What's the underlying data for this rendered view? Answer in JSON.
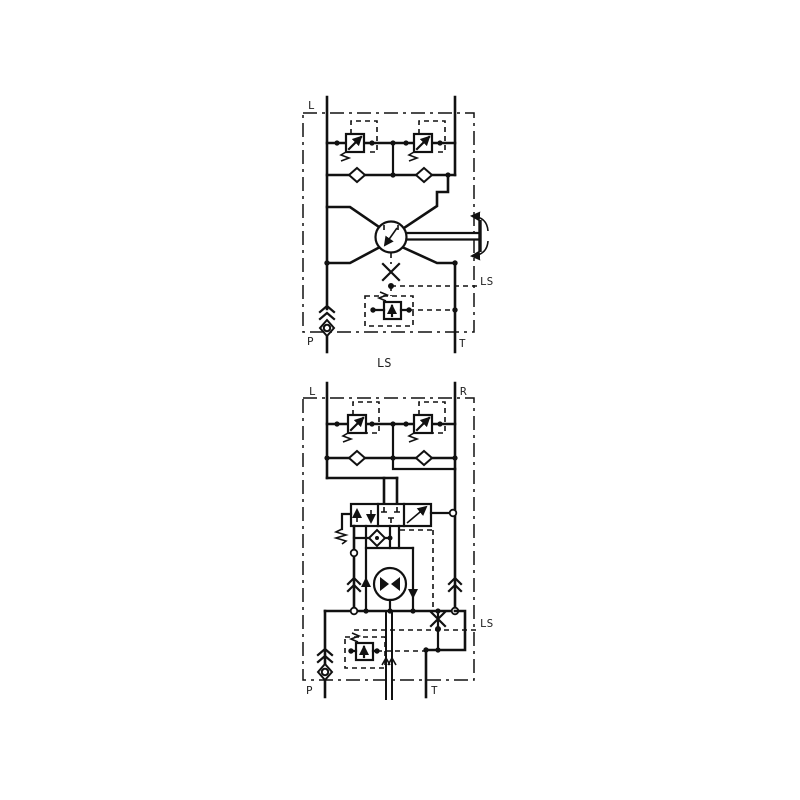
{
  "top": {
    "label_l": "L",
    "label_p": "P",
    "label_t": "T",
    "label_ls": "LS",
    "caption": "LS"
  },
  "bottom": {
    "label_l": "L",
    "label_r": "R",
    "label_p": "P",
    "label_t": "T",
    "label_ls": "LS"
  },
  "colors": {
    "line": "#111111",
    "background": "#ffffff"
  }
}
